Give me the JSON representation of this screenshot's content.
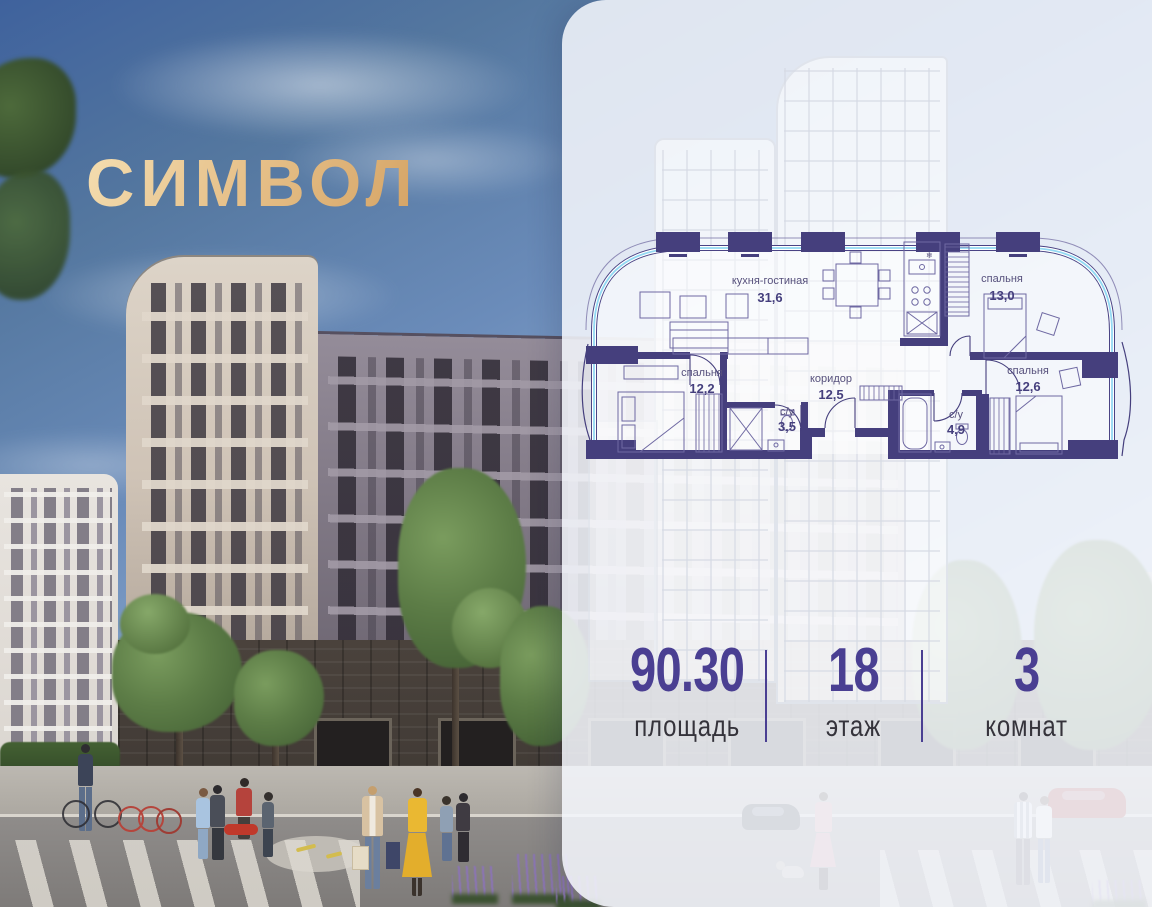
{
  "logo": {
    "text": "СИМВОЛ",
    "color_light": "#f2daac",
    "color_dark": "#d4a263"
  },
  "floor_plan": {
    "wall_color": "#453f7d",
    "glazing_color": "#93d9f3",
    "label_color": "#56507c",
    "ac_symbol": "❄",
    "rooms": [
      {
        "name": "кухня-гостиная",
        "area": "31,6"
      },
      {
        "name": "спальня",
        "area": "13,0"
      },
      {
        "name": "спальня",
        "area": "12,2"
      },
      {
        "name": "коридор",
        "area": "12,5"
      },
      {
        "name": "с/у",
        "area": "3,5"
      },
      {
        "name": "с/у",
        "area": "4,9"
      },
      {
        "name": "спальня",
        "area": "12,6"
      }
    ]
  },
  "stats": [
    {
      "value": "90.30",
      "label": "площадь"
    },
    {
      "value": "18",
      "label": "этаж"
    },
    {
      "value": "3",
      "label": "комнат"
    }
  ],
  "accent_color": "#4a3f92"
}
